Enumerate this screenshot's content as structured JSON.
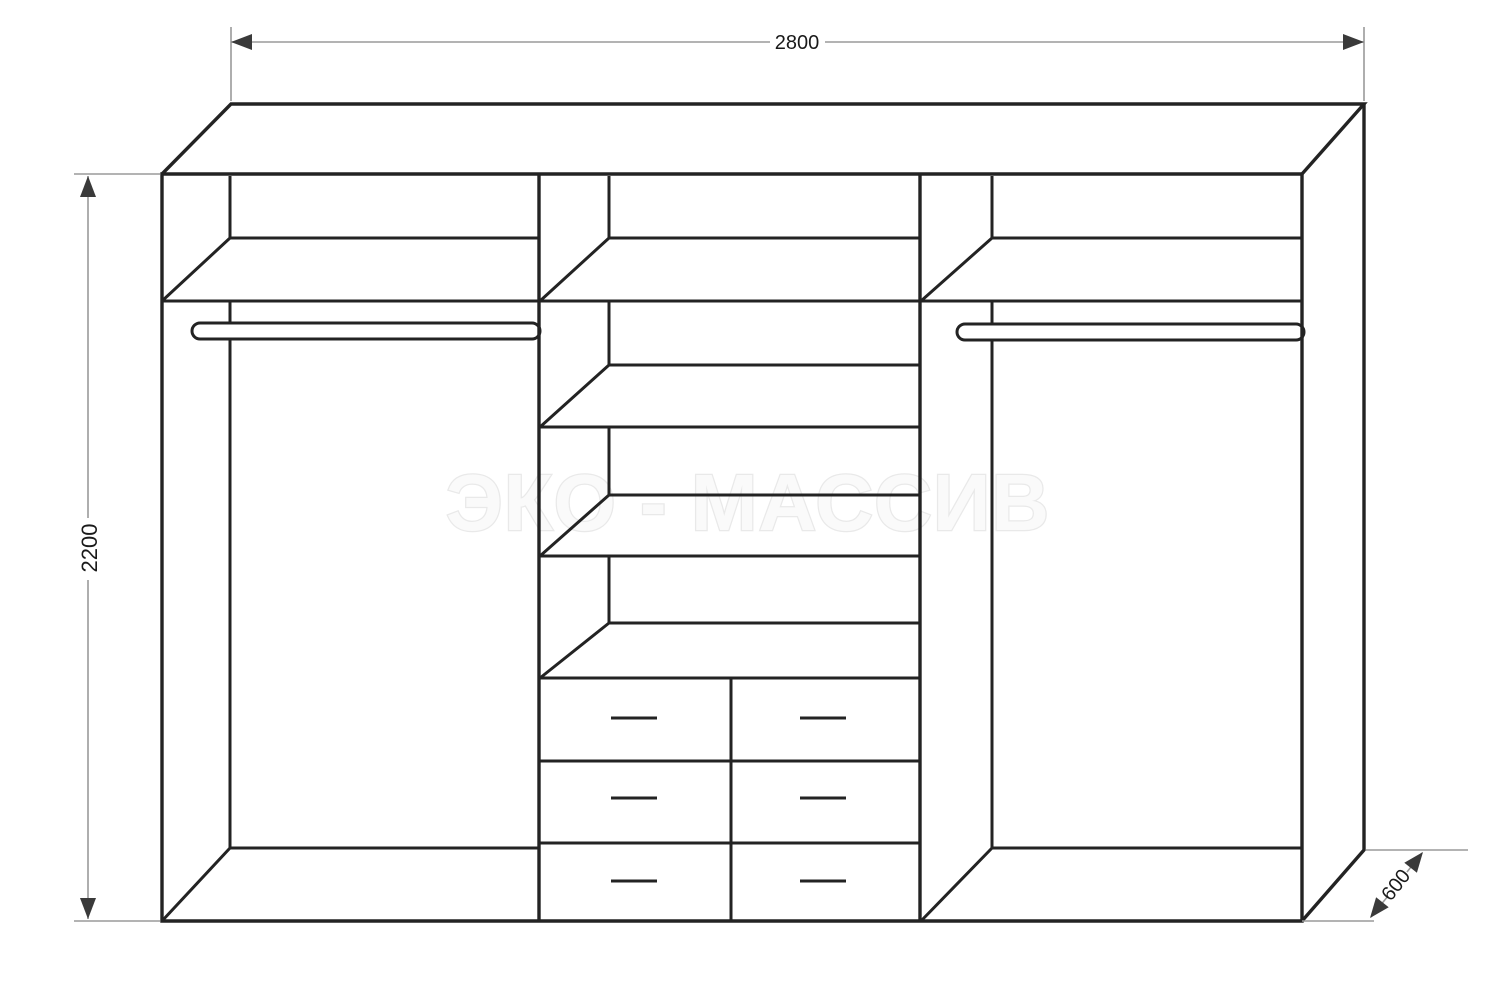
{
  "drawing": {
    "title": "wardrobe-technical-drawing",
    "watermark": "ЭКО - МАССИВ",
    "dimensions": {
      "width_mm": "2800",
      "height_mm": "2200",
      "depth_mm": "600"
    },
    "structure": {
      "sections": 3,
      "left_section": {
        "shelves": 1,
        "hanging_rod": true
      },
      "middle_section": {
        "shelves": 4,
        "drawer_rows": 3,
        "drawer_columns": 2,
        "drawers": 6
      },
      "right_section": {
        "shelves": 1,
        "hanging_rod": true
      }
    },
    "colors": {
      "background": "#ffffff",
      "line": "#232323",
      "dimension_line": "#9a9a9a",
      "arrow": "#3a3a3a",
      "dimension_text": "#1a1a1a",
      "watermark_fill": "#fafafa",
      "watermark_stroke": "#e9e9e9"
    }
  }
}
